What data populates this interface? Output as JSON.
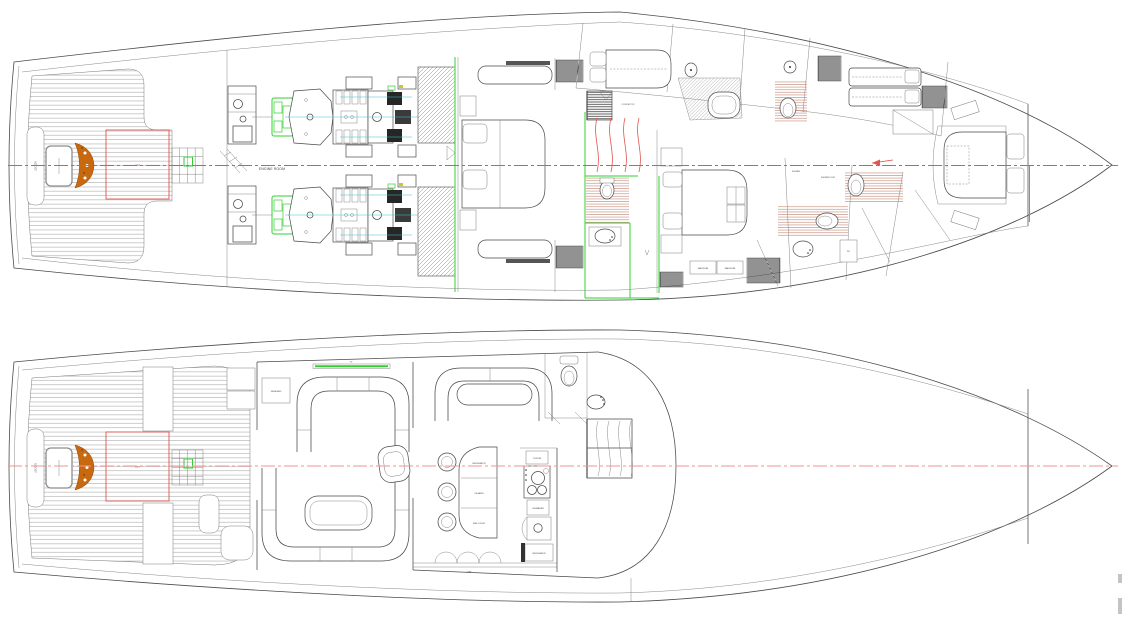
{
  "drawing": {
    "type": "yacht-general-arrangement",
    "plans": [
      {
        "id": "lower-deck-plan"
      },
      {
        "id": "main-deck-plan"
      }
    ]
  },
  "labels": {
    "engine_room": "ENGINE ROOM",
    "locker": "LOCKER",
    "lift": "LIFT",
    "wardrobe": "WARDROBE",
    "shower_door": "SHOWER DOOR",
    "counter": "COUNTER TOP",
    "shower": "SHOWER",
    "wc": "WC",
    "tv": "TV",
    "sideboard": "SIDEBOARD",
    "bar_top": "REFRIGERATOR",
    "bar_mid": "ICE MAKER",
    "bar_bot": "WINE COOLER",
    "galley_top": "COUNTER",
    "galley_dw": "DISHWASHER",
    "galley_fridge": "REFRIGERATOR",
    "step": "STEP"
  },
  "colors": {
    "line": "#4a4a4a",
    "line_light": "#7a7a7a",
    "centerline": "#e2574c",
    "centerline_pale": "#f0958d",
    "green": "#2fd12f",
    "cyan": "#3bc6d4",
    "orange": "#c8690f",
    "orange_dark": "#8a4a0e",
    "floor_hatch": "#bb7863",
    "teak": "#9a9a9a",
    "dark_fill": "#262626",
    "red_detail": "#e0554d"
  }
}
